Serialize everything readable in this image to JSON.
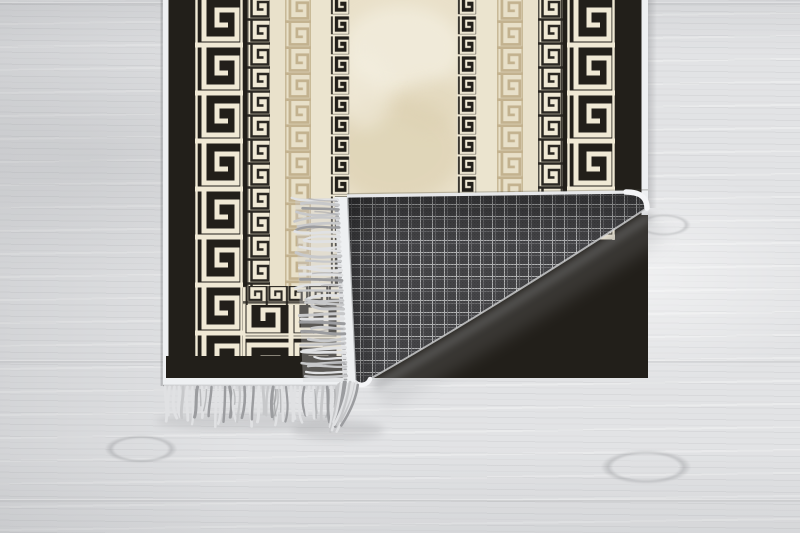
{
  "meta": {
    "description": "Product photo of a black, cream and beige Greek key bordered rug lying on a whitewashed grey wooden floor; the bottom right corner is folded over showing a grey plaid woven backing, a white bound edge and grey fringe tassels."
  },
  "palette": {
    "rug_black": "#221f1a",
    "cream": "#f0e9d5",
    "cream_dim": "#e9e1cb",
    "cream_light": "#ebe4cf",
    "tan": "#c3b28f",
    "tan_bg": "#e8e0c9",
    "center_base": "#e9e0c9",
    "center_light": "#f3eedf",
    "center_dark": "#dacead",
    "binding_white": "#eef0f2",
    "binding_bright": "#f4f5f7",
    "key_black": "#2a2722",
    "plaid_base": "#47474a",
    "plaid_bright": "#c9cacc",
    "plaid_dim": "#7f7f82",
    "fringe_light": "#e0e1e3",
    "fringe_mid": "#c7c8ca",
    "fringe_dark": "#9b9c9f",
    "shadow": "#8f9093"
  },
  "wood": {
    "seams_y": [
      2,
      360,
      499
    ],
    "knots": [
      {
        "x": 92,
        "y": 430,
        "w": 98,
        "h": 38
      },
      {
        "x": 585,
        "y": 444,
        "w": 122,
        "h": 46
      },
      {
        "x": 628,
        "y": 210,
        "w": 72,
        "h": 30
      }
    ]
  },
  "rug": {
    "area": {
      "left": 163,
      "top": -6,
      "right": 648,
      "pattern_bottom": 358,
      "margin_bottom": 378,
      "edge_bottom": 385
    },
    "stripes": [
      {
        "name": "left-binding",
        "type": "binding",
        "x": 163,
        "w": 5.5,
        "bottom": 385
      },
      {
        "name": "left-black-band",
        "type": "black",
        "x": 168.5,
        "w": 26.5,
        "bottom": 378
      },
      {
        "name": "left-large-key",
        "type": "keyLarge",
        "x": 195,
        "w": 48,
        "bottom": 358
      },
      {
        "name": "left-gap",
        "type": "black",
        "x": 243,
        "w": 4,
        "bottom": 358
      },
      {
        "name": "left-small-key-dark",
        "type": "keySmallDark",
        "x": 247,
        "w": 23,
        "bottom": 286
      },
      {
        "name": "left-cream-strip",
        "type": "cream",
        "x": 270,
        "w": 15,
        "bottom": 286
      },
      {
        "name": "left-tan-key",
        "type": "keyTan",
        "x": 285,
        "w": 26,
        "bottom": 286
      },
      {
        "name": "left-light-strip",
        "type": "creamLight",
        "x": 311,
        "w": 19,
        "bottom": 286
      },
      {
        "name": "left-small-key-light",
        "type": "keySmallLight",
        "x": 330,
        "w": 20,
        "bottom": 286
      },
      {
        "name": "center-field",
        "type": "center",
        "x": 350,
        "w": 107,
        "bottom": 286
      },
      {
        "name": "right-small-key-light",
        "type": "keySmallLight",
        "x": 457,
        "w": 20,
        "bottom": 240
      },
      {
        "name": "right-light-strip",
        "type": "creamLight",
        "x": 477,
        "w": 20,
        "bottom": 240
      },
      {
        "name": "right-tan-key",
        "type": "keyTan",
        "x": 497,
        "w": 26,
        "bottom": 240
      },
      {
        "name": "right-cream-strip",
        "type": "cream",
        "x": 523,
        "w": 15,
        "bottom": 240
      },
      {
        "name": "right-small-key-dark",
        "type": "keySmallDark",
        "x": 538,
        "w": 25,
        "bottom": 240
      },
      {
        "name": "right-gap",
        "type": "black",
        "x": 563,
        "w": 4,
        "bottom": 240
      },
      {
        "name": "right-large-key",
        "type": "keyLarge",
        "x": 567,
        "w": 48,
        "bottom": 240
      },
      {
        "name": "right-black-band",
        "type": "black",
        "x": 615,
        "w": 26.5,
        "bottom": 240
      },
      {
        "name": "right-binding",
        "type": "binding",
        "x": 641.5,
        "w": 6.5,
        "bottom": 215
      }
    ],
    "bands": {
      "small_key": {
        "x": 243,
        "y": 286,
        "w": 119,
        "h": 19
      },
      "large_key": {
        "x": 243,
        "y": 305,
        "w": 119,
        "h": 53
      },
      "black_margin": {
        "x": 166,
        "y": 356,
        "w": 198,
        "h": 23
      },
      "bottom_binding": {
        "x": 163,
        "y": 378,
        "w": 199,
        "h": 7
      }
    },
    "fold": {
      "crease": {
        "x1": 347,
        "y1": 197,
        "x2": 648,
        "y2": 193
      },
      "corner_arc_start_x": 632,
      "corner_radius": 15,
      "hyp_start": {
        "x": 647,
        "y": 208
      },
      "hyp_control": {
        "x": 478,
        "y": 318
      },
      "tip": {
        "x": 370,
        "y": 379
      },
      "tip_end": {
        "x": 355.5,
        "y": 382.5
      },
      "binding_w": 12.5
    },
    "fringe": {
      "bottom": {
        "x0": 165,
        "x1": 339,
        "y": 387,
        "step": 4.0,
        "len_min": 26,
        "len_max": 40
      },
      "side": {
        "y0": 200,
        "y1": 380,
        "x_top": 337,
        "drift": 0.05,
        "step": 4.1,
        "len_min": 30,
        "len_max": 47
      },
      "corner": {
        "count": 14,
        "y": 382,
        "x0": 338,
        "len_min": 32,
        "len_max": 50
      }
    }
  }
}
